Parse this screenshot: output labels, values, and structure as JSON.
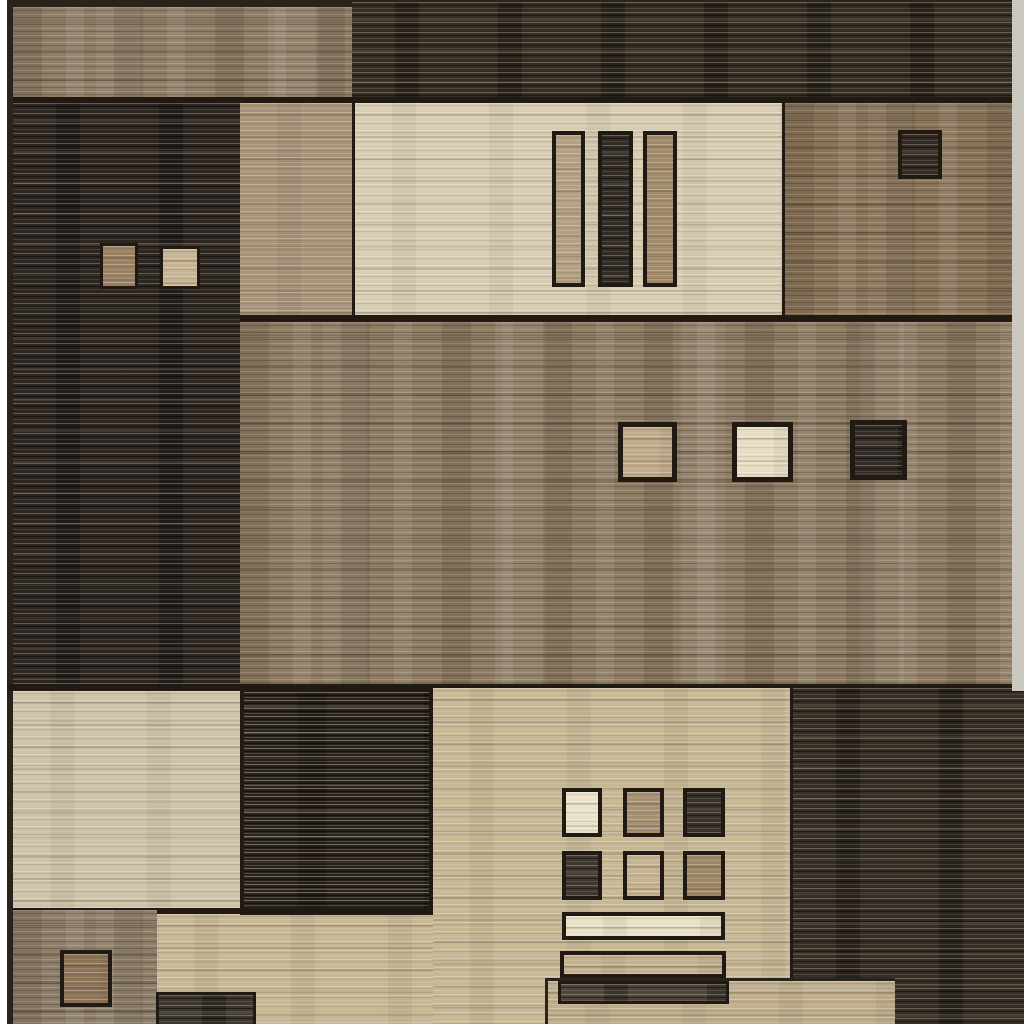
{
  "image": {
    "type": "product-photo",
    "subject": "geometric patchwork area rug",
    "description": "Overhead close-up photo of a rectangular machine-woven area rug composed of striated rectangular color blocks (charcoal, espresso, taupe, tan, beige, cream) with small black-outlined accent squares and horizontal bars; white studio background visible as a thin sliver along the left edge and a pale binding strip along the right edge.",
    "visible_text": ""
  },
  "palette": {
    "page_white": "#ffffff",
    "border_dark": "#2a231b",
    "outline_black": "#201a13",
    "top_taupe": "#8f7d66",
    "dark_band": "#352d24",
    "left_dark": "#2d2620",
    "tan_column": "#a9947a",
    "cream_field": "#d8cdb3",
    "warm_brown": "#8a7459",
    "middle_brown": "#8d7b63",
    "cream_left": "#cec2a9",
    "beige_field": "#c6b795",
    "dark_block": "#352e26",
    "mid_dark": "#29231d",
    "taupe_small": "#8e7e69",
    "beige_lower": "#bfae8d",
    "beige_step": "#c2b291",
    "edge_light": "#cbc8bf",
    "sq_tan_small": "#9b8164",
    "sq_beige_small": "#c7b494",
    "vbar_tan": "#b3a083",
    "vbar_dark": "#332c24",
    "vbar_brown": "#a28b6b",
    "small_dark_sq": "#332c26",
    "mid_sq_tan": "#bfab8b",
    "mid_sq_cream": "#e7ddc3",
    "mid_sq_dark": "#332c26",
    "grid_cream": "#e9e1ca",
    "grid_tan": "#a59072",
    "grid_dark": "#39322a",
    "grid_dark2": "#40382e",
    "grid_beige": "#c4b291",
    "grid_brown": "#9d8767",
    "bar_cream": "#e8e0c6",
    "bar_tan": "#c4b18f",
    "bar_dark": "#4e463c",
    "taupe_square": "#8b7356",
    "bottom_dark_bar": "#3e372d"
  },
  "rug": {
    "rows": [
      "top band: taupe block left, dark charcoal band right",
      "second row: tall dark block (two small squares), tan column, cream field (three vertical bars), warm brown block (one small dark square)",
      "middle: wide mottled brown field with tan, cream and dark accent squares",
      "fourth row: cream block, dark block, beige field with 3x2 square grid and three stacked bars, dark block right",
      "bottom strip: taupe block with brown square, beige run with dark bar, lower tan panel"
    ]
  }
}
